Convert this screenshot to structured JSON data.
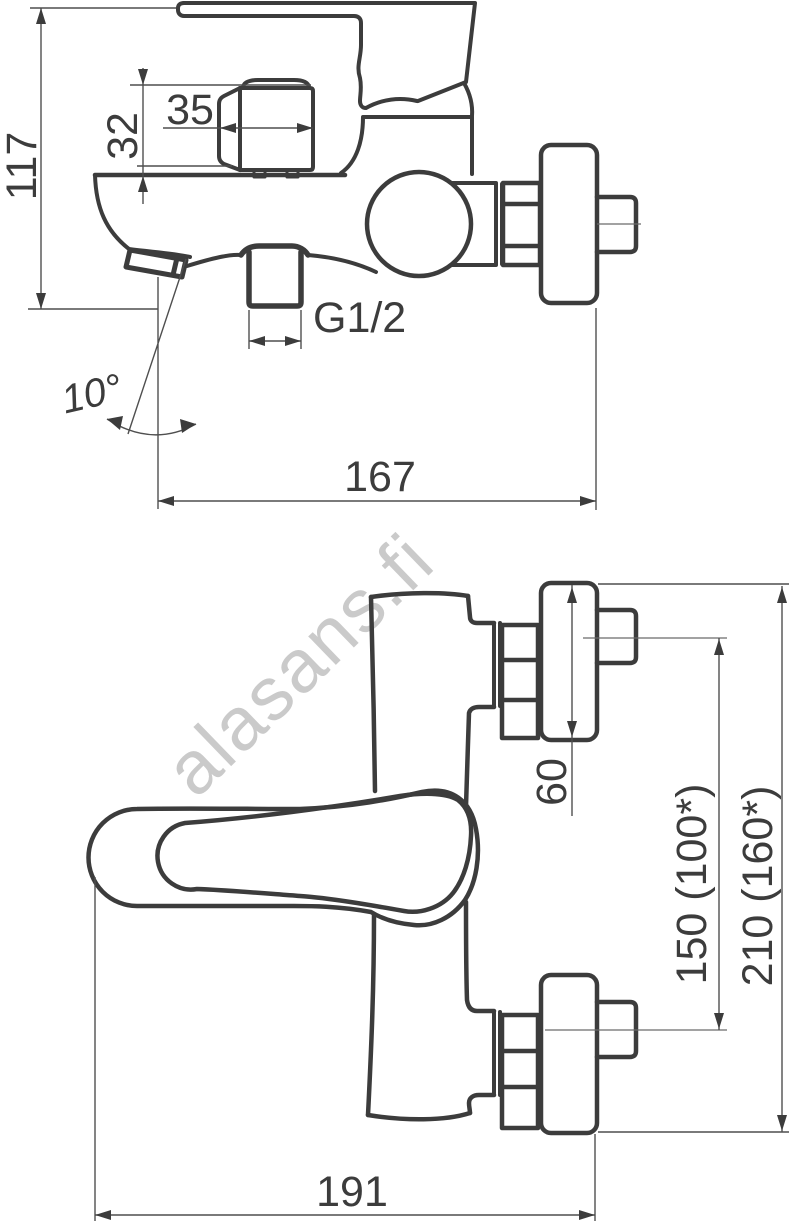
{
  "watermark": {
    "text": "alasans.fi"
  },
  "side_view": {
    "dims": {
      "overall_height": "117",
      "knob_width": "35",
      "knob_height": "32",
      "outlet_thread": "G1/2",
      "spout_angle": "10°",
      "depth_from_wall": "167"
    }
  },
  "front_view": {
    "dims": {
      "flange_diameter": "60",
      "connection_cc": "150 (100*)",
      "overall_cc": "210 (160*)",
      "overall_width": "191"
    }
  },
  "colors": {
    "line": "#3c3c3c",
    "dim_line": "#4f4f4f",
    "watermark": "#cacaca"
  }
}
